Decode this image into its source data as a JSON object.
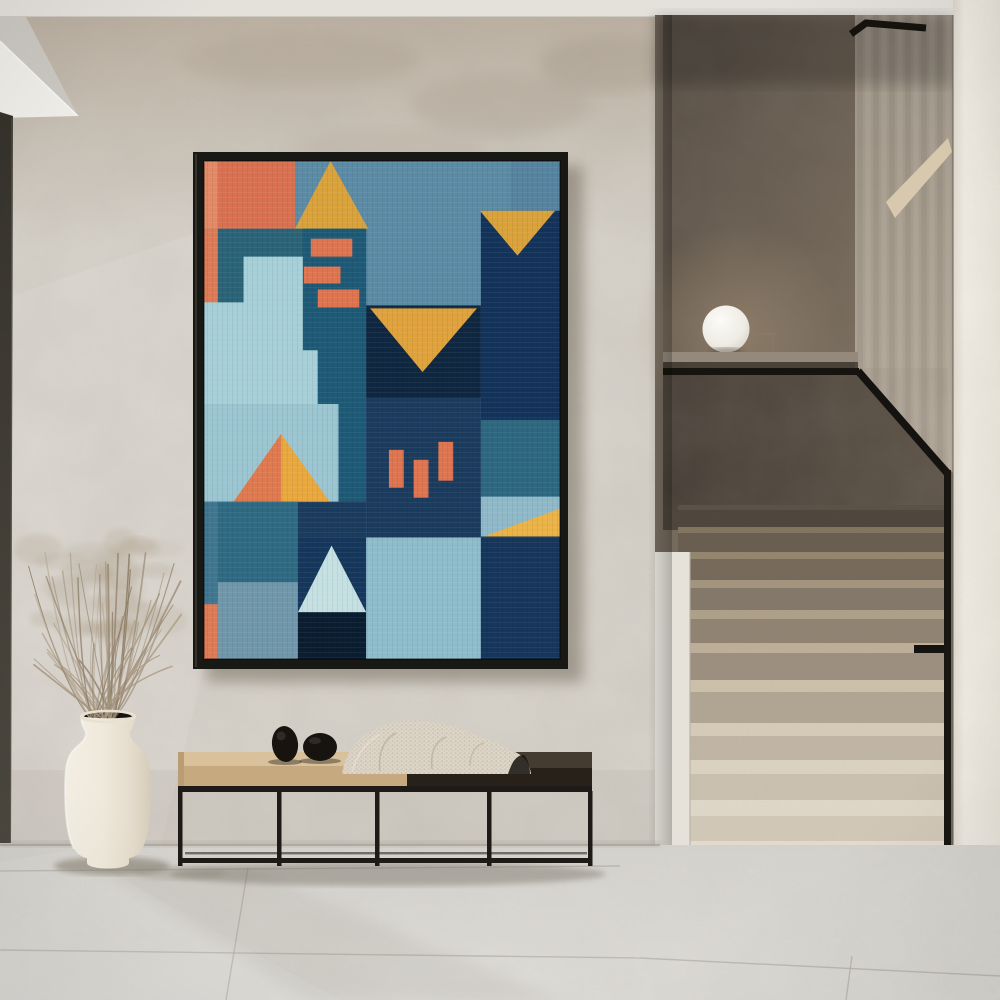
{
  "scene": {
    "width": 1000,
    "height": 1000
  },
  "palette": {
    "ceiling": "#E4E1DB",
    "soffit_gray": "#CBC8C2",
    "soffit_bright": "#EFEDE8",
    "wall": "#D7D3CB",
    "wall_top_tint": "#B3A594",
    "door_frame": "#3E3B33",
    "stair_back_wall": "#6B6055",
    "stair_side_wall": "#A89E90",
    "stair_parapet_dark": "#473F37",
    "stair_parapet_light": "#5D5348",
    "stair_ceiling_band": "#D8C9AE",
    "ledge": "#94897B",
    "rail": "#17140F",
    "lamp_globe": "#F7F5F0",
    "right_wall": "#EDEAE2",
    "stair_side_bright": "#E6E2DA",
    "floor": "#D8D6D1",
    "frame": "#181815",
    "art_shadow": "#6E6557",
    "bench_metal": "#1D1A17",
    "cushion_top": "#D8C19B",
    "cushion_front": "#C6A97E",
    "bench_wood_top": "#453C31",
    "bench_wood_front": "#272119",
    "blanket": "#DCD4C6",
    "blanket_fold": "#B9AC98",
    "stone": "#17130F",
    "vase_light": "#F4EFE4",
    "vase_mid": "#EDE6D8",
    "vase_dark": "#D8CEBC",
    "vase_opening": "#171310",
    "grass_stroke_colors": [
      "#9A8A72",
      "#8B7B64",
      "#A79681",
      "#B1A08A"
    ],
    "grass_fluff": "#A18F76",
    "joint": "#A29D92"
  },
  "artwork": {
    "x": 204,
    "y": 161,
    "width": 356,
    "height": 498,
    "frame": {
      "x": 193,
      "y": 152,
      "width": 375,
      "height": 517
    },
    "canvas_units": [
      360,
      500
    ],
    "shapes": [
      {
        "t": "rect",
        "x": 0,
        "y": 0,
        "w": 360,
        "h": 500,
        "f": "#5C8BA6"
      },
      {
        "t": "rect",
        "x": 310,
        "y": 0,
        "w": 50,
        "h": 50,
        "f": "#5684A0"
      },
      {
        "t": "rect",
        "x": 0,
        "y": 0,
        "w": 92,
        "h": 68,
        "f": "#D97151"
      },
      {
        "t": "rect",
        "x": 0,
        "y": 0,
        "w": 14,
        "h": 68,
        "f": "#E28A66"
      },
      {
        "t": "poly",
        "p": [
          [
            128,
            0
          ],
          [
            166,
            68
          ],
          [
            92,
            68
          ]
        ],
        "f": "#D9A23B"
      },
      {
        "t": "rect",
        "x": 14,
        "y": 68,
        "w": 150,
        "h": 176,
        "f": "#2B6378"
      },
      {
        "t": "poly",
        "p": [
          [
            100,
            68
          ],
          [
            164,
            68
          ],
          [
            164,
            342
          ],
          [
            136,
            342
          ],
          [
            136,
            244
          ],
          [
            100,
            244
          ]
        ],
        "f": "#1E5A76"
      },
      {
        "t": "rect",
        "x": 108,
        "y": 78,
        "w": 42,
        "h": 18,
        "f": "#DE7450"
      },
      {
        "t": "rect",
        "x": 101,
        "y": 106,
        "w": 37,
        "h": 17,
        "f": "#DE7450"
      },
      {
        "t": "rect",
        "x": 115,
        "y": 129,
        "w": 42,
        "h": 18,
        "f": "#DE7450"
      },
      {
        "t": "rect",
        "x": 0,
        "y": 68,
        "w": 14,
        "h": 74,
        "f": "#DD7B57"
      },
      {
        "t": "poly",
        "p": [
          [
            40,
            96
          ],
          [
            100,
            96
          ],
          [
            100,
            190
          ],
          [
            115,
            190
          ],
          [
            115,
            244
          ],
          [
            0,
            244
          ],
          [
            0,
            142
          ],
          [
            40,
            142
          ]
        ],
        "f": "#A6CFD8"
      },
      {
        "t": "rect",
        "x": 164,
        "y": 145,
        "w": 116,
        "h": 93,
        "f": "#0F2740"
      },
      {
        "t": "poly",
        "p": [
          [
            168,
            148
          ],
          [
            276,
            148
          ],
          [
            221,
            212
          ]
        ],
        "f": "#DFA23C"
      },
      {
        "t": "rect",
        "x": 280,
        "y": 50,
        "w": 80,
        "h": 210,
        "f": "#14335A"
      },
      {
        "t": "poly",
        "p": [
          [
            279,
            50
          ],
          [
            355,
            50
          ],
          [
            317,
            95
          ]
        ],
        "f": "#D9A23B"
      },
      {
        "t": "rect",
        "x": 164,
        "y": 238,
        "w": 116,
        "h": 140,
        "f": "#1B3C5E"
      },
      {
        "t": "rect",
        "x": 95,
        "y": 342,
        "w": 69,
        "h": 36,
        "f": "#1B3C5E"
      },
      {
        "t": "rect",
        "x": 187,
        "y": 290,
        "w": 15,
        "h": 38,
        "f": "#DE7450"
      },
      {
        "t": "rect",
        "x": 212,
        "y": 300,
        "w": 15,
        "h": 38,
        "f": "#DE7450"
      },
      {
        "t": "rect",
        "x": 237,
        "y": 282,
        "w": 15,
        "h": 39,
        "f": "#DE7450"
      },
      {
        "t": "rect",
        "x": 0,
        "y": 244,
        "w": 136,
        "h": 98,
        "f": "#9BC5D0"
      },
      {
        "t": "poly",
        "p": [
          [
            78,
            274
          ],
          [
            127,
            342
          ],
          [
            30,
            342
          ]
        ],
        "f": "#E9A83E"
      },
      {
        "t": "poly",
        "p": [
          [
            78,
            274
          ],
          [
            78,
            342
          ],
          [
            30,
            342
          ]
        ],
        "f": "#DF7A50"
      },
      {
        "t": "rect",
        "x": 14,
        "y": 342,
        "w": 81,
        "h": 81,
        "f": "#2F6A82"
      },
      {
        "t": "rect",
        "x": 0,
        "y": 342,
        "w": 14,
        "h": 103,
        "f": "#40768F"
      },
      {
        "t": "rect",
        "x": 0,
        "y": 445,
        "w": 14,
        "h": 55,
        "f": "#DD7B57"
      },
      {
        "t": "rect",
        "x": 14,
        "y": 423,
        "w": 81,
        "h": 77,
        "f": "#7197AB"
      },
      {
        "t": "rect",
        "x": 95,
        "y": 378,
        "w": 69,
        "h": 75,
        "f": "#16375C"
      },
      {
        "t": "poly",
        "p": [
          [
            129,
            386
          ],
          [
            164,
            453
          ],
          [
            95,
            453
          ]
        ],
        "f": "#C5E0E2"
      },
      {
        "t": "rect",
        "x": 95,
        "y": 453,
        "w": 69,
        "h": 47,
        "f": "#0B1D31"
      },
      {
        "t": "rect",
        "x": 164,
        "y": 378,
        "w": 116,
        "h": 122,
        "f": "#8FBCCB"
      },
      {
        "t": "rect",
        "x": 280,
        "y": 260,
        "w": 80,
        "h": 77,
        "f": "#2D6880"
      },
      {
        "t": "rect",
        "x": 280,
        "y": 337,
        "w": 80,
        "h": 40,
        "f": "#8FB9C8"
      },
      {
        "t": "poly",
        "p": [
          [
            283,
            377
          ],
          [
            360,
            349
          ],
          [
            360,
            377
          ]
        ],
        "f": "#EBB347"
      },
      {
        "t": "rect",
        "x": 280,
        "y": 377,
        "w": 80,
        "h": 123,
        "f": "#16365C"
      }
    ]
  },
  "staircase": {
    "right_edge": 945,
    "steps": [
      {
        "y": 505,
        "h": 22,
        "face": "#4D453C",
        "tread": "#5A5146",
        "th": 5,
        "x": 678
      },
      {
        "y": 527,
        "h": 25,
        "face": "#685D4F",
        "tread": "#82755F",
        "th": 6,
        "x": 678
      },
      {
        "y": 552,
        "h": 28,
        "face": "#77695A",
        "tread": "#94866F",
        "th": 7,
        "x": 682
      },
      {
        "y": 580,
        "h": 30,
        "face": "#84786A",
        "tread": "#A3957E",
        "th": 8,
        "x": 686
      },
      {
        "y": 610,
        "h": 33,
        "face": "#908372",
        "tread": "#AFA18A",
        "th": 9,
        "x": 690
      },
      {
        "y": 643,
        "h": 37,
        "face": "#9D9080",
        "tread": "#BEB09A",
        "th": 10,
        "x": 690
      },
      {
        "y": 680,
        "h": 43,
        "face": "#B2A694",
        "tread": "#CEC2AC",
        "th": 12,
        "x": 690
      },
      {
        "y": 723,
        "h": 37,
        "face": "#C2B7A5",
        "tread": "#D7CDBA",
        "th": 13,
        "x": 690
      },
      {
        "y": 760,
        "h": 40,
        "face": "#CCC2B1",
        "tread": "#DDD4C3",
        "th": 14,
        "x": 690
      },
      {
        "y": 800,
        "h": 41,
        "face": "#D3CABA",
        "tread": "#E1D9CA",
        "th": 16,
        "x": 690
      },
      {
        "y": 841,
        "h": 44,
        "face": "#D9D0C1",
        "tread": "#E5DED1",
        "th": 18,
        "x": 690
      },
      {
        "y": 885,
        "h": 52,
        "face": "#DED6C8",
        "tread": "#E8E2D6",
        "th": 20,
        "x": 690
      }
    ]
  },
  "floor": {
    "joints": [
      [
        0,
        871,
        620,
        866
      ],
      [
        0,
        950,
        640,
        958
      ],
      [
        640,
        958,
        1000,
        976
      ],
      [
        248,
        868,
        226,
        1000
      ],
      [
        852,
        956,
        846,
        1000
      ]
    ]
  },
  "bench": {
    "legs_x": [
      178,
      277,
      375,
      487,
      588
    ],
    "leg_w": 4.5,
    "leg_top": 791,
    "leg_bottom": 866,
    "stones": [
      {
        "cx": 285,
        "cy": 744,
        "rx": 13,
        "ry": 18,
        "rot": -6
      },
      {
        "cx": 320,
        "cy": 747,
        "rx": 17,
        "ry": 14,
        "rot": 0
      }
    ]
  },
  "plant": {
    "seed": 7,
    "stem_count": 52,
    "fluff_count": 26,
    "base_x": 102,
    "base_y": 720
  }
}
